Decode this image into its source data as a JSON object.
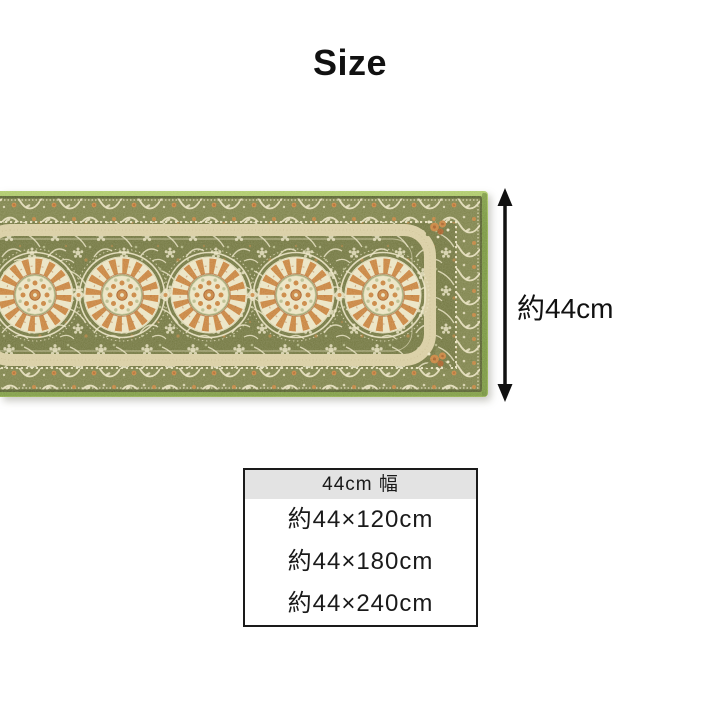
{
  "page": {
    "title": "Size"
  },
  "rug": {
    "label": "green ornamental runner rug with five floral medallions",
    "medallion_count": 5,
    "colors": {
      "edge_green": "#8FAE4C",
      "edge_green_light": "#AECB6A",
      "edge_green_dark": "#6E8C38",
      "edge_dark_line": "#555F2D",
      "band_olive": "#7C8149",
      "field_olive": "#70753E",
      "cream": "#EBE4C4",
      "beige": "#D8CDA2",
      "orange": "#C8823C",
      "orange_dark": "#A75E27",
      "pale_green": "#B9BD8D"
    }
  },
  "dimension": {
    "height_label": "約44cm",
    "arrow_color": "#111111"
  },
  "size_table": {
    "header": "44cm 幅",
    "rows": [
      "約44×120cm",
      "約44×180cm",
      "約44×240cm"
    ],
    "header_bg": "#E3E3E3",
    "border_color": "#1A1A1A"
  }
}
